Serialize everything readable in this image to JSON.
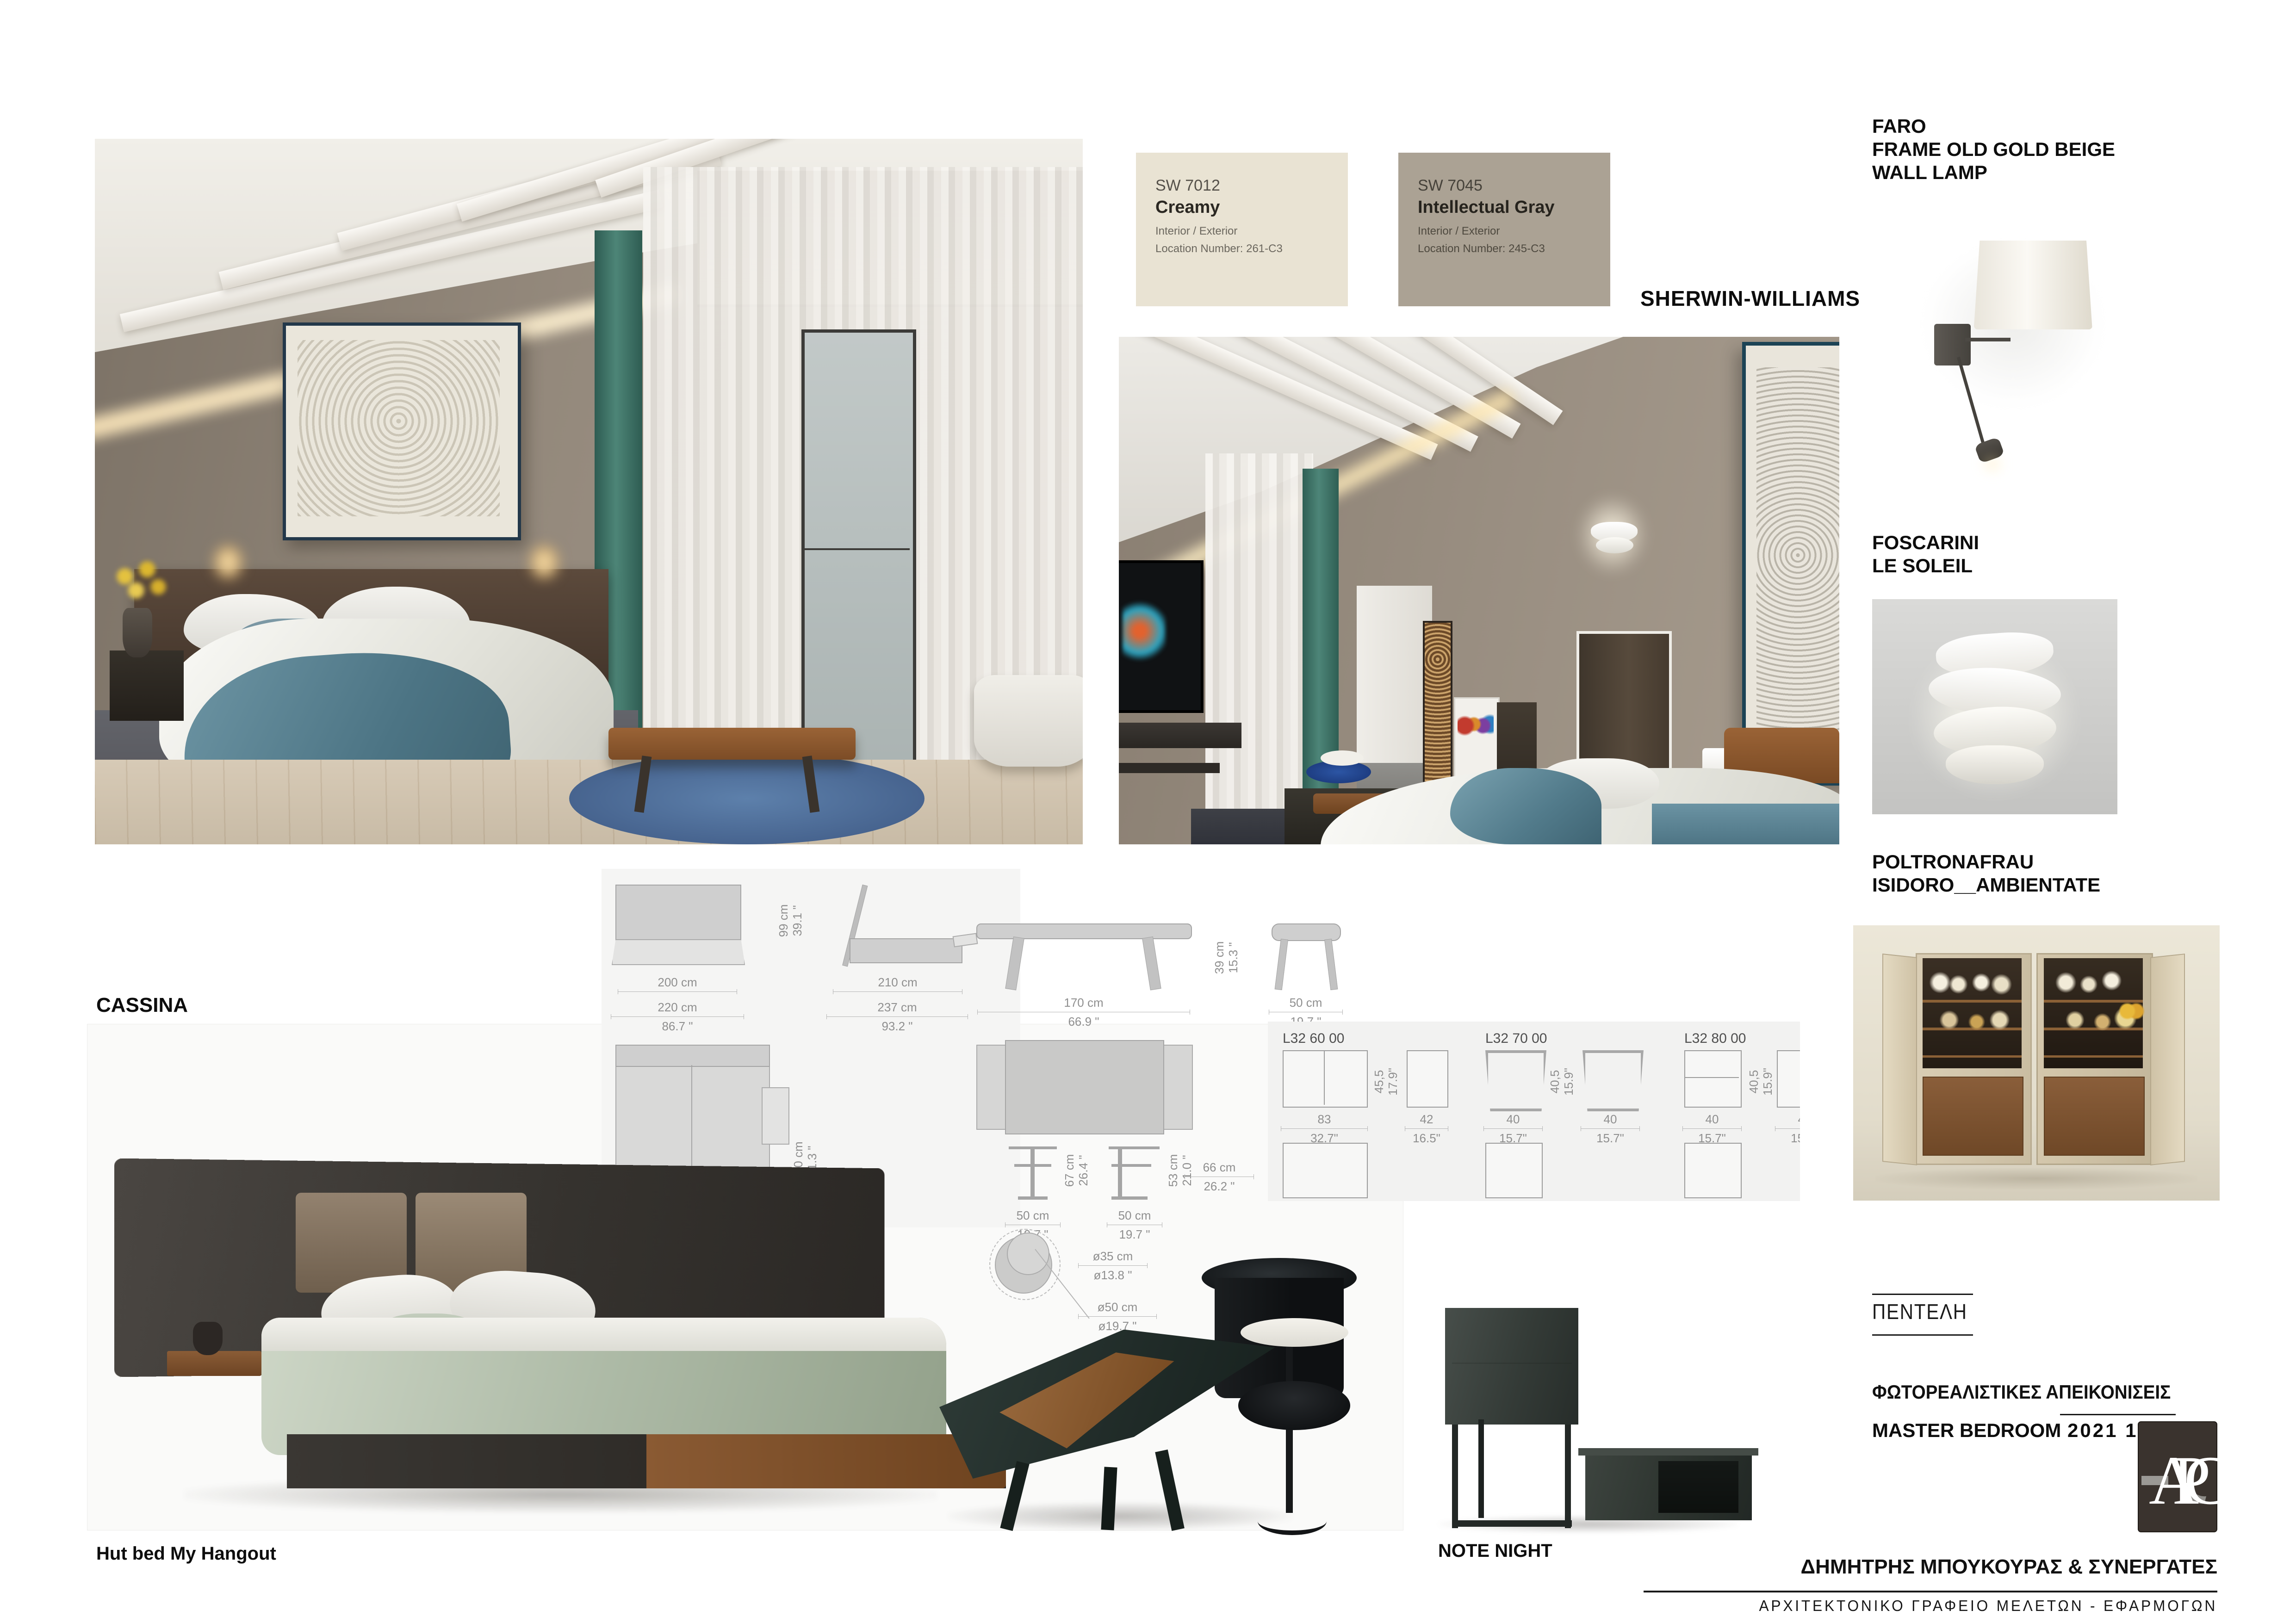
{
  "swatches": {
    "brand": "SHERWIN-WILLIAMS",
    "items": [
      {
        "code": "SW 7012",
        "name": "Creamy",
        "subtitle": "Interior / Exterior",
        "location": "Location Number: 261-C3",
        "color": "#e9e3d3"
      },
      {
        "code": "SW 7045",
        "name": "Intellectual Gray",
        "subtitle": "Interior / Exterior",
        "location": "Location Number: 245-C3",
        "color": "#aba294"
      }
    ]
  },
  "products": {
    "faro_title": "FARO\nFRAME OLD GOLD BEIGE\nWALL LAMP",
    "foscarini_title": "FOSCARINI\nLE SOLEIL",
    "poltronafrau_title": "POLTRONAFRAU\nISIDORO__AMBIENTATE",
    "cassina": "CASSINA",
    "hut_bed": "Hut bed My Hangout",
    "note_night": "NOTE NIGHT"
  },
  "titleblock": {
    "project": "ΠΕΝΤΕΛΗ",
    "subtitle": "ΦΩΤΟΡΕΑΛΙΣΤΙΚΕΣ ΑΠΕΙΚΟΝΙΣΕΙΣ",
    "room": "MASTER BEDROOM",
    "date": "2021 12 11",
    "firm": "ΔΗΜΗΤΡΗΣ ΜΠΟΥΚΟΥΡΑΣ & ΣΥΝΕΡΓΑΤΕΣ",
    "firm_sub": "ΑΡΧΙΤΕΚΤΟΝΙΚΟ ΓΡΑΦΕΙΟ ΜΕΛΕΤΩΝ - ΕΦΑΡΜΟΓΩΝ",
    "logo_letters": "APC"
  },
  "drawings": {
    "bed": {
      "w_cm": "200 cm",
      "w2_cm": "220 cm",
      "w2_in": "86.7 \"",
      "d_cm": "210 cm",
      "d2_cm": "237 cm",
      "d2_in": "93.2 \"",
      "h_cm": "99 cm",
      "h_in": "39.1 \"",
      "top_cm": "130 cm",
      "top_in": "51.3 \""
    },
    "bench": {
      "w_cm": "170 cm",
      "w_in": "66.9 \"",
      "h_cm": "39 cm",
      "h_in": "15.3 \"",
      "stool_cm": "50 cm",
      "stool_in": "19.7 \""
    },
    "tables": {
      "t1_h_cm": "67 cm",
      "t1_h_in": "26.4 \"",
      "t2_h_cm": "53 cm",
      "t2_h_in": "21.0 \"",
      "t1_w_cm": "50 cm",
      "t1_w_in": "19.7 \"",
      "t2_w_cm": "50 cm",
      "t2_w_in": "19.7 \"",
      "depth_cm": "66 cm",
      "depth_in": "26.2 \"",
      "c1": "ø35 cm",
      "c1_in": "ø13.8 \"",
      "c2": "ø50 cm",
      "c2_in": "ø19.7 \""
    },
    "l32": [
      {
        "label": "L32 60 00",
        "h_cm": "45,5",
        "h_in": "17.9\"",
        "w_cm": "83",
        "w_in": "32.7\"",
        "d_cm": "42",
        "d_in": "16.5\""
      },
      {
        "label": "L32 70 00",
        "h_cm": "40,5",
        "h_in": "15.9\"",
        "w_cm": "40",
        "w_in": "15.7\"",
        "d_cm": "40",
        "d_in": "15.7\""
      },
      {
        "label": "L32 80 00",
        "h_cm": "40,5",
        "h_in": "15.9\"",
        "w_cm": "40",
        "w_in": "15.7\"",
        "d_cm": "40",
        "d_in": "15.7\""
      }
    ]
  }
}
